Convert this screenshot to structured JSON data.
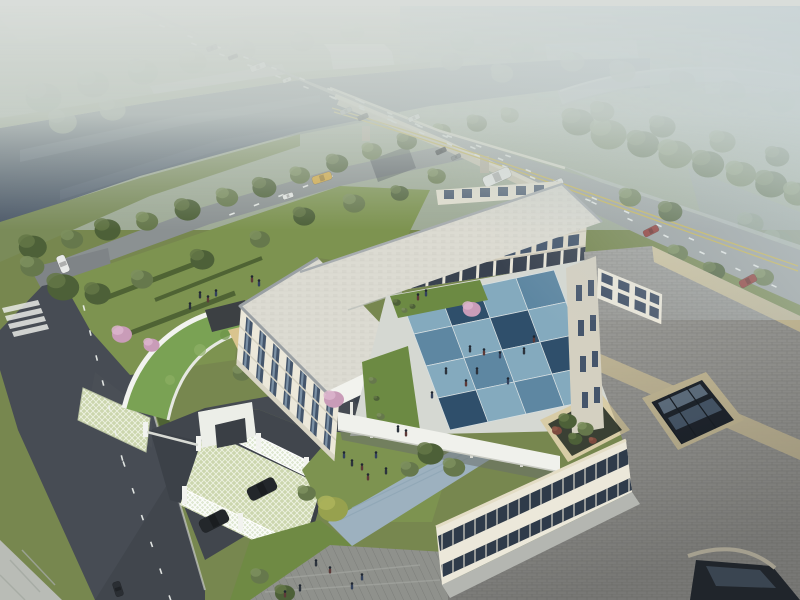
{
  "meta": {
    "title": "Aerial architectural rendering: three-story cream building complex with blue checkerboard courtyard, riverside highway bridge, gardens and parking"
  },
  "palette": {
    "sky_haze": "#d9ddda",
    "haze_blue": "#c8d3d6",
    "water": "#4d5a6b",
    "water_light": "#6b7787",
    "lawn": "#77874f",
    "lawn_bright": "#7d9350",
    "road_gray": "#9aa0a0",
    "road_dark": "#474c54",
    "asphalt_court": "#41464d",
    "lane_white": "#eef1ee",
    "lane_yellow": "#c9b44a",
    "bridge_cream": "#ddd8c6",
    "building_cream": "#ece8da",
    "building_shade": "#ded9c9",
    "roof_pale": "#dcdbd2",
    "roof_gray": "#a7a7a3",
    "roof_beige": "#d8cca6",
    "green_roof": "#7aa254",
    "court_blue_light": "#84aabe",
    "court_blue_mid": "#5e87a2",
    "court_blue_dark": "#2f4f6b",
    "glass": "#44556b",
    "glass_light": "#8ea4b8",
    "deck_gray": "#8f918c",
    "walkway_blue": "#9db1bf",
    "grid_paver": "#ccd6ae",
    "tree_colors": {
      "d": [
        "#4d6038",
        "#647747"
      ],
      "m": [
        "#66784c",
        "#7d8f5e"
      ],
      "l": [
        "#7e9058",
        "#93a36b"
      ],
      "y": [
        "#97a14e",
        "#adb45c"
      ],
      "p": [
        "#c99cb8",
        "#dcb5cd"
      ],
      "h": [
        "#8b9b88",
        "#9aa996"
      ],
      "r": [
        "#7c4a3e",
        "#8f5a4a"
      ]
    },
    "vehicle_colors": {
      "dark": "#2a2e33",
      "gray": "#6f7579",
      "white": "#e8eae8",
      "silver": "#9aa0a4",
      "red": "#8f3732",
      "yellow": "#d8a93c",
      "suv": "#23272b"
    },
    "people_colors": [
      "#2c333d",
      "#5d3a38",
      "#33415c"
    ]
  },
  "scene": {
    "trees": [
      [
        40,
        95,
        18,
        "h",
        0
      ],
      [
        90,
        82,
        16,
        "h",
        0
      ],
      [
        140,
        70,
        15,
        "h",
        0
      ],
      [
        190,
        60,
        14,
        "h",
        0
      ],
      [
        240,
        48,
        13,
        "h",
        0
      ],
      [
        60,
        120,
        14,
        "h",
        0
      ],
      [
        110,
        108,
        13,
        "h",
        0
      ],
      [
        300,
        40,
        12,
        "h",
        0
      ],
      [
        350,
        30,
        12,
        "h",
        0
      ],
      [
        400,
        22,
        11,
        "h",
        0
      ],
      [
        460,
        40,
        12,
        "h",
        0
      ],
      [
        520,
        50,
        12,
        "h",
        0
      ],
      [
        570,
        60,
        12,
        "h",
        0
      ],
      [
        620,
        70,
        13,
        "h",
        0
      ],
      [
        680,
        80,
        13,
        "h",
        0
      ],
      [
        730,
        90,
        13,
        "h",
        0
      ],
      [
        780,
        100,
        13,
        "h",
        0
      ],
      [
        450,
        60,
        11,
        "h",
        0
      ],
      [
        500,
        72,
        11,
        "h",
        0
      ],
      [
        30,
        245,
        14,
        "d",
        0
      ],
      [
        70,
        238,
        11,
        "m",
        0
      ],
      [
        105,
        228,
        13,
        "d",
        0
      ],
      [
        145,
        220,
        11,
        "m",
        0
      ],
      [
        185,
        208,
        13,
        "d",
        0
      ],
      [
        225,
        196,
        11,
        "m",
        0
      ],
      [
        262,
        186,
        12,
        "d",
        0
      ],
      [
        298,
        174,
        10,
        "m",
        0
      ],
      [
        335,
        162,
        11,
        "d",
        0
      ],
      [
        370,
        150,
        10,
        "m",
        0
      ],
      [
        405,
        140,
        10,
        "d",
        0
      ],
      [
        440,
        130,
        9,
        "m",
        0
      ],
      [
        475,
        122,
        10,
        "d",
        0
      ],
      [
        508,
        114,
        9,
        "m",
        0
      ],
      [
        575,
        120,
        16,
        "d",
        0
      ],
      [
        605,
        132,
        18,
        "m",
        0
      ],
      [
        640,
        142,
        16,
        "d",
        0
      ],
      [
        672,
        152,
        17,
        "m",
        0
      ],
      [
        705,
        162,
        16,
        "d",
        0
      ],
      [
        738,
        172,
        15,
        "m",
        0
      ],
      [
        768,
        182,
        16,
        "d",
        0
      ],
      [
        795,
        192,
        14,
        "m",
        0
      ],
      [
        600,
        110,
        12,
        "m",
        0
      ],
      [
        660,
        125,
        13,
        "d",
        0
      ],
      [
        720,
        140,
        13,
        "m",
        0
      ],
      [
        775,
        155,
        12,
        "d",
        0
      ],
      [
        748,
        222,
        13,
        "h",
        0
      ],
      [
        775,
        240,
        14,
        "h",
        0
      ],
      [
        60,
        285,
        16,
        "d",
        1
      ],
      [
        30,
        265,
        12,
        "m",
        1
      ],
      [
        95,
        292,
        13,
        "d",
        1
      ],
      [
        140,
        278,
        11,
        "m",
        1
      ],
      [
        200,
        258,
        12,
        "d",
        1
      ],
      [
        258,
        238,
        10,
        "m",
        1
      ],
      [
        302,
        215,
        11,
        "d",
        1
      ],
      [
        352,
        202,
        11,
        "m",
        1
      ],
      [
        398,
        192,
        9,
        "d",
        1
      ],
      [
        435,
        175,
        9,
        "m",
        1
      ],
      [
        120,
        333,
        10,
        "p",
        1
      ],
      [
        150,
        344,
        8,
        "p",
        1
      ],
      [
        240,
        372,
        9,
        "m",
        1
      ],
      [
        270,
        360,
        8,
        "d",
        1
      ],
      [
        300,
        352,
        8,
        "m",
        1
      ],
      [
        285,
        390,
        9,
        "d",
        1
      ],
      [
        310,
        378,
        7,
        "m",
        1
      ],
      [
        330,
        507,
        15,
        "y",
        1
      ],
      [
        305,
        492,
        9,
        "m",
        1
      ],
      [
        283,
        592,
        10,
        "d",
        1
      ],
      [
        258,
        575,
        9,
        "m",
        1
      ],
      [
        628,
        196,
        11,
        "m",
        1
      ],
      [
        668,
        210,
        12,
        "d",
        1
      ],
      [
        676,
        252,
        10,
        "m",
        1
      ],
      [
        712,
        270,
        11,
        "d",
        1
      ],
      [
        762,
        276,
        10,
        "m",
        1
      ],
      [
        428,
        452,
        13,
        "d",
        2
      ],
      [
        452,
        466,
        11,
        "m",
        2
      ],
      [
        408,
        468,
        9,
        "m",
        2
      ],
      [
        470,
        308,
        9,
        "p",
        2
      ],
      [
        332,
        398,
        10,
        "p",
        2
      ],
      [
        566,
        420,
        9,
        "d",
        2
      ],
      [
        584,
        428,
        8,
        "m",
        2
      ],
      [
        574,
        438,
        7,
        "d",
        2
      ],
      [
        592,
        440,
        4,
        "r",
        2
      ],
      [
        556,
        430,
        5,
        "r",
        2
      ],
      [
        396,
        302,
        4,
        "d",
        2
      ],
      [
        404,
        310,
        3,
        "m",
        2
      ],
      [
        412,
        306,
        3,
        "d",
        2
      ],
      [
        372,
        380,
        4,
        "m",
        2
      ],
      [
        376,
        398,
        3,
        "d",
        2
      ],
      [
        380,
        416,
        4,
        "m",
        2
      ]
    ],
    "people": [
      [
        470,
        352
      ],
      [
        484,
        355
      ],
      [
        500,
        358
      ],
      [
        477,
        374
      ],
      [
        466,
        386
      ],
      [
        508,
        384
      ],
      [
        524,
        354
      ],
      [
        534,
        342
      ],
      [
        432,
        398
      ],
      [
        446,
        374
      ],
      [
        418,
        300
      ],
      [
        426,
        296
      ],
      [
        352,
        466
      ],
      [
        362,
        470
      ],
      [
        376,
        458
      ],
      [
        386,
        474
      ],
      [
        368,
        480
      ],
      [
        344,
        458
      ],
      [
        316,
        566
      ],
      [
        330,
        573
      ],
      [
        352,
        589
      ],
      [
        300,
        591
      ],
      [
        285,
        597
      ],
      [
        362,
        580
      ],
      [
        200,
        298
      ],
      [
        208,
        302
      ],
      [
        216,
        296
      ],
      [
        190,
        309
      ],
      [
        252,
        282
      ],
      [
        259,
        286
      ],
      [
        398,
        432
      ],
      [
        406,
        436
      ]
    ],
    "vehicles": [
      [
        212,
        48,
        11,
        5,
        -21,
        "gray"
      ],
      [
        233,
        57,
        10,
        4,
        -21,
        "dark"
      ],
      [
        258,
        67,
        16,
        6,
        -21,
        "white"
      ],
      [
        287,
        80,
        9,
        4,
        -21,
        "white"
      ],
      [
        346,
        111,
        12,
        5,
        -22,
        "silver"
      ],
      [
        363,
        117,
        11,
        5,
        -22,
        "dark"
      ],
      [
        414,
        118,
        12,
        5,
        -22,
        "white"
      ],
      [
        441,
        151,
        11,
        5,
        -24,
        "dark"
      ],
      [
        456,
        157,
        10,
        4,
        -24,
        "gray"
      ],
      [
        497,
        177,
        29,
        11,
        -24,
        "white"
      ],
      [
        557,
        183,
        13,
        6,
        -25,
        "white"
      ],
      [
        651,
        231,
        16,
        7,
        -27,
        "red"
      ],
      [
        748,
        281,
        18,
        8,
        -28,
        "red"
      ],
      [
        322,
        178,
        20,
        8,
        -18,
        "yellow"
      ],
      [
        288,
        196,
        11,
        5,
        -18,
        "white"
      ],
      [
        63,
        264,
        18,
        9,
        68,
        "white"
      ],
      [
        118,
        589,
        15,
        8,
        72,
        "dark"
      ],
      [
        262,
        489,
        30,
        14,
        -27,
        "suv"
      ],
      [
        214,
        521,
        30,
        14,
        -27,
        "suv"
      ]
    ],
    "lane_dashes": [
      [
        162,
        26,
        358,
        100,
        7
      ],
      [
        362,
        102,
        556,
        182,
        7
      ],
      [
        562,
        185,
        756,
        266,
        6
      ],
      [
        194,
        44,
        390,
        120,
        7
      ],
      [
        394,
        122,
        588,
        200,
        7
      ],
      [
        594,
        203,
        774,
        286,
        5
      ],
      [
        332,
        97,
        508,
        156,
        6
      ],
      [
        84,
        308,
        122,
        458,
        6
      ],
      [
        124,
        464,
        170,
        598,
        5
      ],
      [
        232,
        214,
        330,
        177,
        4
      ]
    ]
  }
}
